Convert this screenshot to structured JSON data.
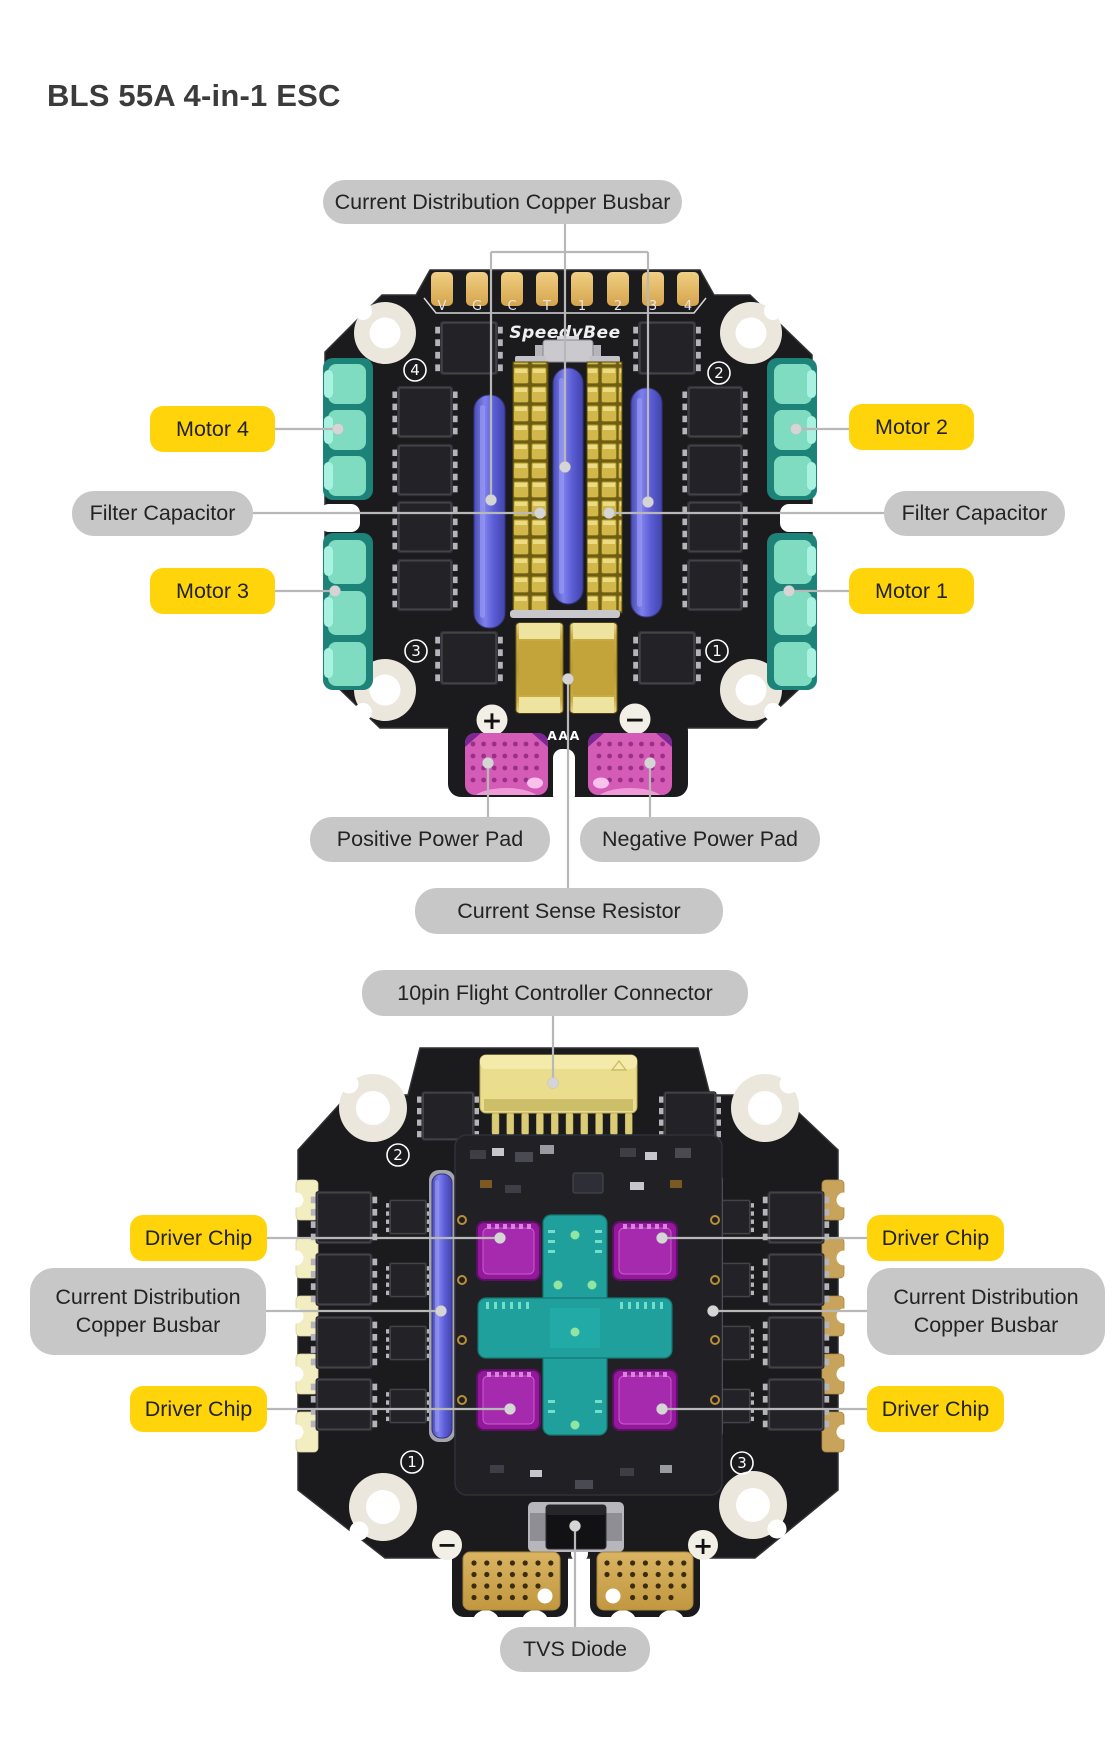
{
  "title": "BLS 55A 4-in-1 ESC",
  "colors": {
    "label_yellow": "#FFD40A",
    "label_gray": "#C7C7C7",
    "label_text": "#232323",
    "board_black": "#1B1B1E",
    "busbar_blue": "#5C5ED8",
    "capacitor_gold": "#D2B74A",
    "motor_pad_teal": "#7FDCC0",
    "power_pad_pink": "#D45CB6",
    "driver_chip_purple": "#A52AAD",
    "mcu_teal": "#1FA09D",
    "callout_line": "#B8B8B8"
  },
  "front_board": {
    "silkscreen": {
      "logo": "SpeedyBee",
      "pin_labels": [
        "V",
        "G",
        "C",
        "T",
        "1",
        "2",
        "3",
        "4"
      ],
      "corner_numbers": {
        "top_left": "4",
        "top_right": "2",
        "bottom_left": "3",
        "bottom_right": "1"
      },
      "positive_mark": "+",
      "negative_mark": "−",
      "shunt_mark": "AAA"
    },
    "callouts": [
      {
        "id": "current-distribution-copper-busbar",
        "text": "Current Distribution Copper Busbar",
        "style": "gray"
      },
      {
        "id": "motor-4",
        "text": "Motor 4",
        "style": "yellow"
      },
      {
        "id": "motor-2",
        "text": "Motor 2",
        "style": "yellow"
      },
      {
        "id": "filter-capacitor-left",
        "text": "Filter Capacitor",
        "style": "gray"
      },
      {
        "id": "filter-capacitor-right",
        "text": "Filter Capacitor",
        "style": "gray"
      },
      {
        "id": "motor-3",
        "text": "Motor 3",
        "style": "yellow"
      },
      {
        "id": "motor-1",
        "text": "Motor 1",
        "style": "yellow"
      },
      {
        "id": "positive-power-pad",
        "text": "Positive Power Pad",
        "style": "gray"
      },
      {
        "id": "negative-power-pad",
        "text": "Negative Power Pad",
        "style": "gray"
      },
      {
        "id": "current-sense-resistor",
        "text": "Current Sense Resistor",
        "style": "gray"
      }
    ]
  },
  "back_board": {
    "silkscreen": {
      "corner_numbers": {
        "top_left": "2",
        "top_right": "4",
        "bottom_left": "1",
        "bottom_right": "3"
      },
      "positive_mark": "+",
      "negative_mark": "−"
    },
    "callouts": [
      {
        "id": "10pin-flight-controller-connector",
        "text": "10pin Flight Controller Connector",
        "style": "gray"
      },
      {
        "id": "driver-chip-top-left",
        "text": "Driver Chip",
        "style": "yellow"
      },
      {
        "id": "driver-chip-top-right",
        "text": "Driver Chip",
        "style": "yellow"
      },
      {
        "id": "current-distribution-copper-busbar-left",
        "text": "Current Distribution Copper Busbar",
        "style": "gray"
      },
      {
        "id": "current-distribution-copper-busbar-right",
        "text": "Current Distribution Copper Busbar",
        "style": "gray"
      },
      {
        "id": "driver-chip-bottom-left",
        "text": "Driver Chip",
        "style": "yellow"
      },
      {
        "id": "driver-chip-bottom-right",
        "text": "Driver Chip",
        "style": "yellow"
      },
      {
        "id": "tvs-diode",
        "text": "TVS Diode",
        "style": "gray"
      }
    ]
  }
}
